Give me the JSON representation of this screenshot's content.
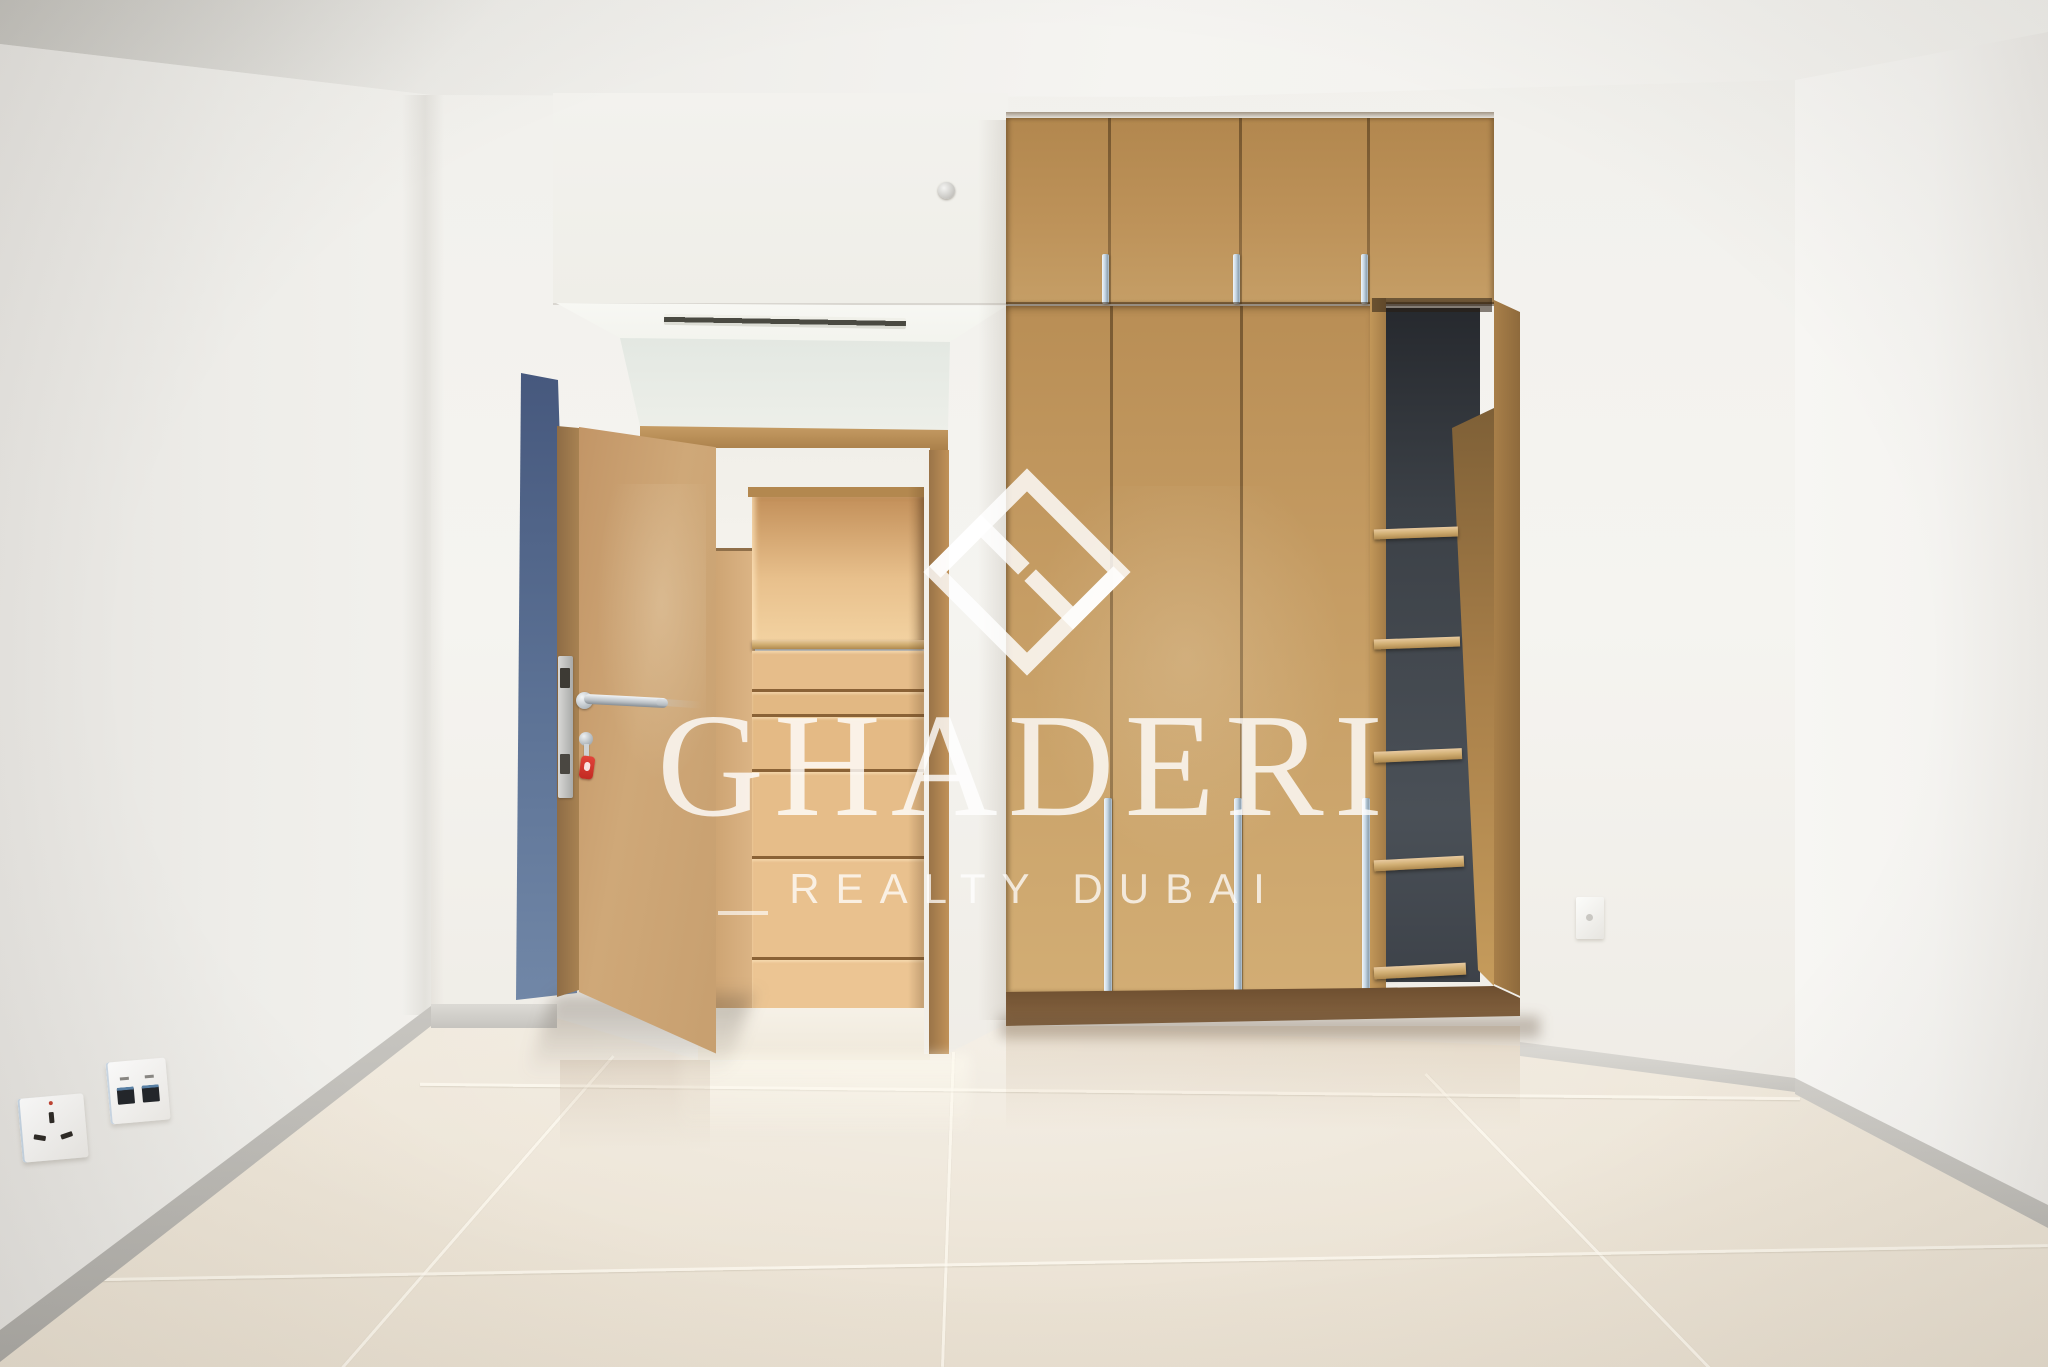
{
  "meta": {
    "kind": "real-estate-photograph",
    "room": "empty bedroom with built-in wardrobe"
  },
  "watermark": {
    "brand": "GHADERI",
    "tagline": "REALTY DUBAI",
    "color": "#ffffff"
  },
  "palette": {
    "wall": "#f3f2ee",
    "ceiling": "#f1f0ec",
    "floor": "#ece4d6",
    "skirting": "#b8b6b1",
    "wardrobe_wood": "#c09760",
    "wardrobe_plinth": "#7b5a39",
    "door_wood": "#c9a373",
    "hallway_closet_wood": "#e7bd8b",
    "shelf_back": "#41464c",
    "accent_wall_blue": "#5d7396",
    "chrome": "#c7d4df",
    "key_tag_red": "#d62f28"
  },
  "objects": {
    "ceiling_vent": "linear slot ceiling diffuser",
    "hallway_vent": "slim slot diffuser above doorway",
    "bedroom_door": "open oak door with chrome lever handle",
    "key_tag": "key with red tag in lock cylinder",
    "wardrobe": "floor-to-ceiling oak wardrobe",
    "wardrobe_upper_door_count": 4,
    "wardrobe_tall_door_count": 3,
    "open_shelf_count": 5,
    "hallway_closet": "built-in closet with open shelf and drawers",
    "hallway_closet_drawer_count": 4,
    "outlet_left_power": "UK 3-pin power socket",
    "outlet_left_media": "media / data outlet plate",
    "outlet_right": "small wall socket"
  }
}
